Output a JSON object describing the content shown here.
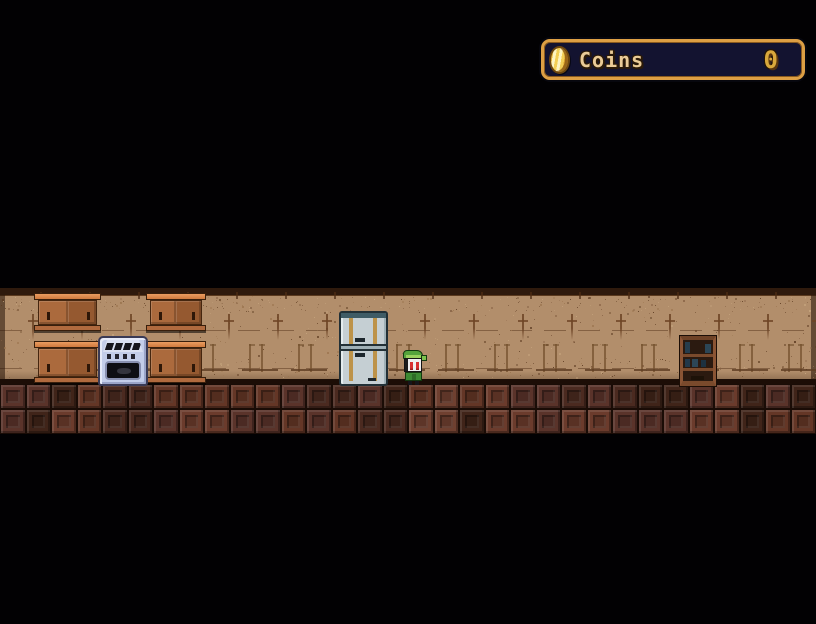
{
  "hud": {
    "coins_panel": {
      "label": "Coins",
      "value": "0",
      "icon": "coin",
      "colors": {
        "border_gold": "#dd9f44",
        "background": "#131330",
        "label_text": "#eacb97",
        "value_text": "#d9a83c",
        "coin_gold": "#f3cf55",
        "coin_shine": "#fdf4c0"
      }
    }
  },
  "scene": {
    "room": "kitchen",
    "entities": [
      {
        "name": "wall-cabinet-upper-left"
      },
      {
        "name": "wall-cabinet-upper-right"
      },
      {
        "name": "wall-cabinet-lower-left"
      },
      {
        "name": "wall-cabinet-lower-right"
      },
      {
        "name": "stove"
      },
      {
        "name": "refrigerator"
      },
      {
        "name": "player-character"
      },
      {
        "name": "bookshelf"
      }
    ],
    "palette": {
      "background": "#020103",
      "wall_base": "#b28e6b",
      "wall_top_strip": "#2f1a0d",
      "wall_mark": "#6e4526",
      "wall_mark_light": "#75522f",
      "wall_tick": "#4f2d16",
      "wall_speckles": [
        "#8a6547",
        "#6e4c2f",
        "#9c7650",
        "#c6a57e",
        "#5d3c22"
      ],
      "floor_grout": "#1c0d06",
      "floor_tiles": [
        "#6b3b2c",
        "#5a332a",
        "#4b2a20",
        "#643626",
        "#402419",
        "#6f4030"
      ],
      "cabinet_wood": "#9d5e35",
      "cabinet_trim": "#e09155",
      "stove_body": "#c3cdea",
      "fridge_body": "#c5cfd3",
      "fridge_trim": "#bd9349",
      "player_green": "#55a33c",
      "player_eyes": "#d83030",
      "book_teal": [
        "#263d4d",
        "#2c4656",
        "#22384a",
        "#1d3140"
      ]
    }
  }
}
